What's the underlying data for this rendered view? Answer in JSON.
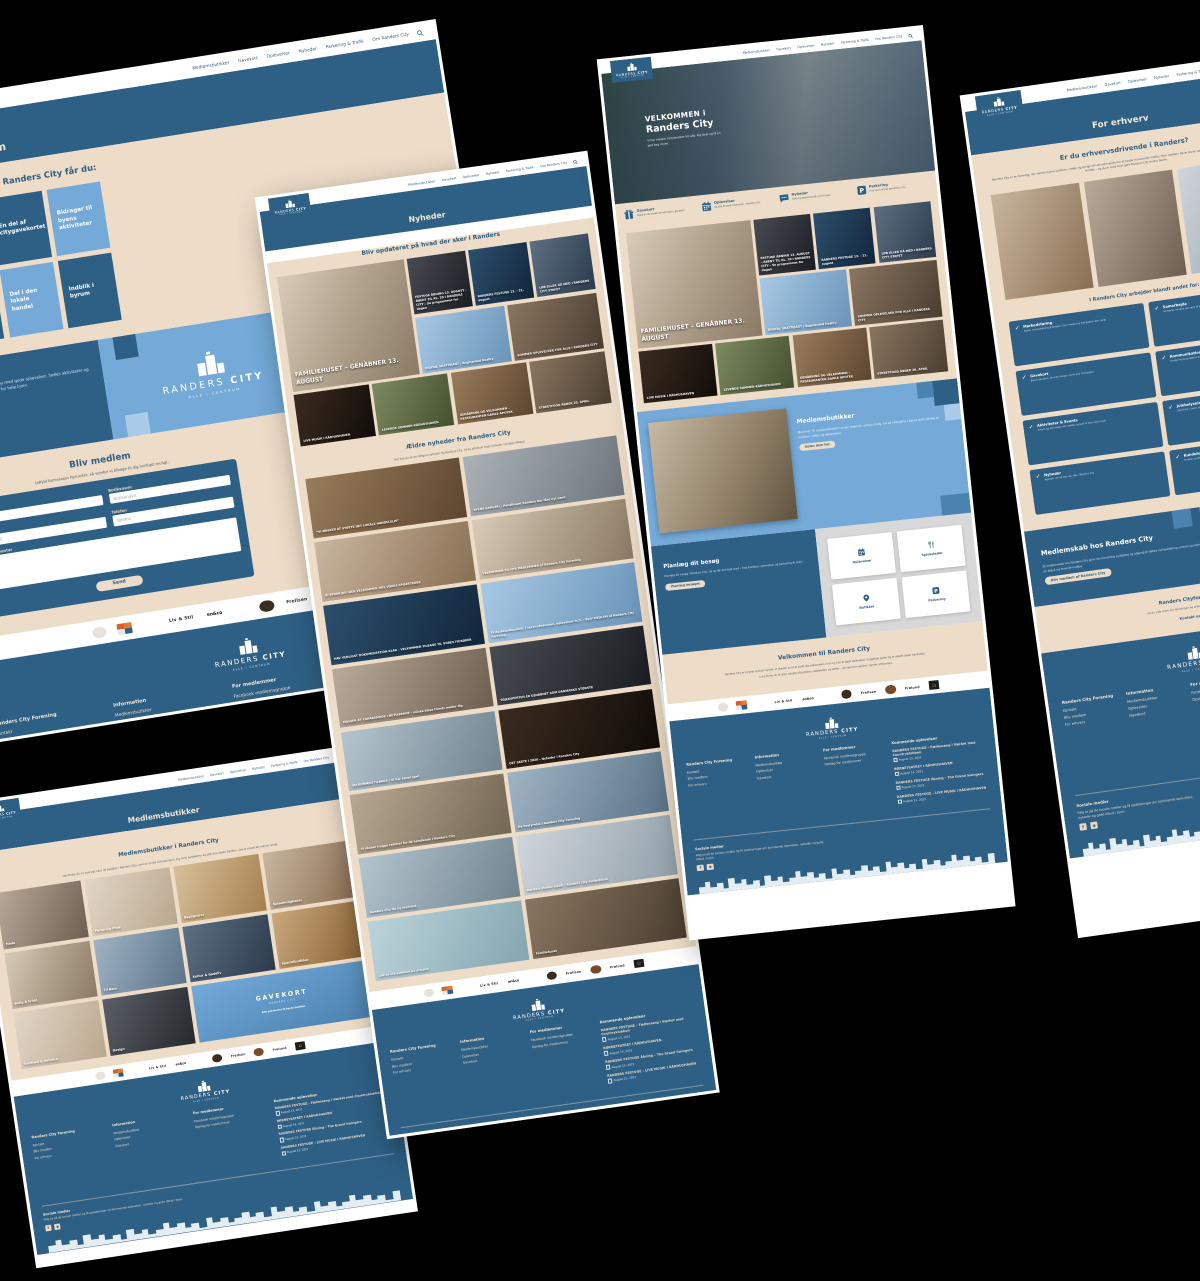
{
  "colors": {
    "navy": "#2e5f84",
    "light_blue": "#74a9d8",
    "pale_blue": "#a9cbe8",
    "beige": "#eddcc7",
    "background": "#000000"
  },
  "brand": {
    "logo_a": "RANDERS",
    "logo_b": "CITY",
    "tagline": "ALLE I CENTRUM"
  },
  "nav": {
    "items": [
      "Medlemsbutikker",
      "Gavekort",
      "Oplevelser",
      "Nyheder",
      "Parkering & Trafik",
      "Om Randers City"
    ],
    "search_icon": "search-icon"
  },
  "partners": [
    {
      "shape": "sh-round",
      "label": ""
    },
    {
      "shape": "sh-pixels",
      "label": ""
    },
    {
      "shape": "sh-text",
      "label": ""
    },
    {
      "shape": "sh-text",
      "label": "Liv & Stil"
    },
    {
      "shape": "sh-stack",
      "label": "en&co"
    },
    {
      "shape": "sh-script",
      "label": ""
    },
    {
      "shape": "sh-round-dark",
      "label": ""
    },
    {
      "shape": "sh-text",
      "label": "Frellsen"
    },
    {
      "shape": "sh-round-brown",
      "label": ""
    },
    {
      "shape": "sh-text",
      "label": "Frølund"
    },
    {
      "shape": "sh-card-dark",
      "label": "12"
    }
  ],
  "news": {
    "featured": {
      "title": "FAMILIEHUSET – GENÅBNER 13. AUGUST",
      "tone": "t-room"
    },
    "row1": [
      {
        "title": "FESTUGE ÅBNING 13. AUGUST – ÅBENT TIL KL. 20 I RANDERS CITY – Se programmet for dagen",
        "tone": "t-dark"
      },
      {
        "title": "RANDERS FESTUGE 13. - 21. august",
        "tone": "t-navy"
      },
      {
        "title": "LØB ELLER GÅ MED I RANDERS CITY STAFET",
        "tone": "t-crowd"
      }
    ],
    "row2": [
      {
        "title": "DIGITAL SKATTEJAGT | Augmented Reality",
        "tone": "t-sky"
      },
      {
        "title": "SOMMER OPLEVELSER FOR ALLE I RANDERS CITY",
        "tone": "t-street"
      }
    ],
    "row3": [
      {
        "title": "LIVE MUSIK I RÅDHUSHAVEN",
        "tone": "t-night"
      },
      {
        "title": "LEVENDE SOMMER-RÅDHUSHAVEN",
        "tone": "t-green"
      },
      {
        "title": "GENÅBNING OG VELKOMMEN – RESTAURANTEN GAMLE APOTEK",
        "tone": "t-warm"
      },
      {
        "title": "STREETFOOD ÅBNER 20. APRIL",
        "tone": "t-street"
      }
    ]
  },
  "footer": {
    "col1": {
      "heading": "Randers City Forening",
      "links": [
        "Kontakt",
        "Bliv medlem",
        "For erhverv"
      ]
    },
    "col2": {
      "heading": "Information",
      "links": [
        "Medlemsbutikker",
        "Oplevelser",
        "Gavekort"
      ]
    },
    "col3": {
      "heading": "For medlemmer",
      "links": [
        "Facebook medlemsgruppe",
        "Opslag for medlemmer"
      ]
    },
    "events_heading": "Kommende oplevelser",
    "events": [
      {
        "title": "RANDERS FESTUGE – Fællessang i Værket med Countryklubben",
        "date": "August 13, 2021"
      },
      {
        "title": "BØRNETEATRET I RÅDHUSHAVEN",
        "date": "August 14, 2021"
      },
      {
        "title": "RANDERS FESTUGE Åbning – The Grand Swingers",
        "date": "August 15, 2021"
      },
      {
        "title": "RANDERS FESTUGE – LIVE MUSIK I RÅDHUSHAVEN",
        "date": "August 21, 2021"
      }
    ],
    "social_heading": "Sociale medier",
    "social_text": "Følg os på de sociale medier og få opdateringer om kommende oplevelser, nyheder og gode tilbud i byen.",
    "social_icons": [
      "facebook-icon",
      "instagram-icon"
    ]
  },
  "bliv_medlem": {
    "title": "Bliv medlem",
    "benefits_heading": "Som medlem af Randers City får du:",
    "benefits": [
      {
        "label": "Årlige netværksaktiviteter",
        "tone": "light"
      },
      {
        "label": "En del af citygavekortet",
        "tone": "dark"
      },
      {
        "label": "Bidrager til byens aktiviteter",
        "tone": "light"
      },
      {
        "label": "Online synlighed",
        "tone": "dark"
      },
      {
        "label": "Del i den lokale handel",
        "tone": "light"
      },
      {
        "label": "Indblik i byrum",
        "tone": "dark"
      }
    ],
    "banner": {
      "heading": "Randers City",
      "text": "Vi arbejder for en levende midtby med gode oplevelser, fælles aktiviteter og en stærk lokal handel – til gavn for hele byen."
    },
    "form": {
      "heading": "Bliv medlem",
      "subheading": "Udfyld formularen herunder, så vender vi tilbage til dig hurtigst muligt.",
      "fields": [
        {
          "label": "Navn",
          "placeholder": "Navn"
        },
        {
          "label": "Butiksnavn",
          "placeholder": "Butiksnavn"
        },
        {
          "label": "E-mail",
          "placeholder": "E-mail"
        },
        {
          "label": "Telefon",
          "placeholder": "Telefon"
        }
      ],
      "textarea_label": "Kommentar",
      "submit_label": "Send"
    }
  },
  "nyheder": {
    "title": "Nyheder",
    "heading": "Bliv opdateret på hvad der sker i Randers",
    "older_heading": "Ældre nyheder fra Randers City",
    "older_sub": "Her kan du se de tidligere nyheder fra Randers City, så du altid kan finde nyheder og kigge tilbage.",
    "articles": [
      {
        "title": "“VI ØNSKER AT STØTTE DET LOKALE HANDELSLIV”",
        "tone": "t-warm"
      },
      {
        "title": "BYENS SAMLERI – Penalhuset Randers har fået nyt navn",
        "tone": "t-grey"
      },
      {
        "title": "VI BYDER JER IGEN VELKOMMEN HOS VORES SPISESTEDER",
        "tone": "t-food"
      },
      {
        "title": "VELKOMMEN TIL NYE MEDLEMMER af Randers City Forening",
        "tone": "t-room"
      },
      {
        "title": "HAV VENLIGST DOKUMENTATION KLAR – VELKOMMEN TILBAGE TIL VORES FRISØRER",
        "tone": "t-navy"
      },
      {
        "title": "Er du detailhandlen, i servicebranchen, oplevelser m.fl. – BLIV MEDLEM af Randers City Forening",
        "tone": "t-sky"
      },
      {
        "title": "MASSER AF FORÅRSMODE I BUTIKKERNE – måske disse trends møder dig",
        "tone": "t-cloth"
      },
      {
        "title": "TØJEKSPERTEN ER GENÅBNET SOM DANMARKS STØRSTE",
        "tone": "t-dark"
      },
      {
        "title": "VELKOMMEN TILBAGE – Vi har åbnet igen",
        "tone": "t-smile"
      },
      {
        "title": "DET SKETE I 2020 – Nyheder i Randers City",
        "tone": "t-night"
      },
      {
        "title": "Vi skaber trygge rammer for de handlende i Randers City",
        "tone": "t-shop"
      },
      {
        "title": "Ny bestyrelse i Randers City Forening",
        "tone": "t-portrait"
      },
      {
        "title": "Randers City får ny identitet",
        "tone": "t-smile"
      },
      {
        "title": "Randers støtter lokalt – Randers City Fordelsklub",
        "tone": "t-poster"
      },
      {
        "title": "Lad os stå sammen på afstand",
        "tone": "t-soap"
      },
      {
        "title": "Familiehuset",
        "tone": "t-street"
      }
    ]
  },
  "forside": {
    "hero": {
      "kicker": "VELKOMMEN i",
      "title": "Randers City",
      "sub": "Vi har masser af oplevelser for alle. Kig forbi og få en god dag i byen."
    },
    "features": [
      {
        "icon": "gift-icon",
        "label": "Gavekort",
        "desc": "Glæd en du holder af med byens gavekort"
      },
      {
        "icon": "calendar-icon",
        "label": "Oplevelser",
        "desc": "Se alle de gode oplevelser i Randers City"
      },
      {
        "icon": "chat-icon",
        "label": "Nyheder",
        "desc": "Hold dig opdateret på nyt fra byen"
      },
      {
        "icon": "parking-icon",
        "label": "Parkering",
        "desc": "Find nemt vej og parkering i city"
      }
    ],
    "butikker": {
      "heading": "Medlemsbutikker",
      "text": "Med over 70 medlemsbutikker er der noget for enhver smag. Gå på opdagelse i byens store udvalg af butikker, caféer og spisesteder.",
      "cta": "Oplev dem her"
    },
    "besoeg": {
      "heading": "Planlæg dit besøg",
      "text": "Planlæg dit besøg i Randers City, så du får det hele med – find butikker, oplevelser og parkering ét sted.",
      "cta": "Planlæg besøget"
    },
    "quick_cards": [
      {
        "icon": "calendar-icon",
        "label": "Oplevelser"
      },
      {
        "icon": "cutlery-icon",
        "label": "Spisesteder"
      },
      {
        "icon": "pin-icon",
        "label": "Butikker"
      },
      {
        "icon": "parking-icon",
        "label": "Parkering"
      }
    ],
    "velkommen": {
      "heading": "Velkommen til Randers City",
      "p1": "Randers City er et godt sted at handle. Vi glæder os til at byde dig velkommen til en by fuld af gode oplevelser, hyggelige gader og et stærkt lokalt handelsliv.",
      "p2": "I city finder du et stort udvalg af butikker, spisesteder og caféer – alt sammen samlet i hjertet af Randers."
    }
  },
  "for_erhverv": {
    "title": "For erhverv",
    "heading": "Er du erhvervsdrivende i Randers?",
    "intro": "Randers City er en forening, der samler byens butikker, caféer og øvrige erhvervsdrivende om at skabe en levende midtby. Som medlem bliver du en del af fællesskabet og får adgang til en række fordele – og du er med til at gøre Randers City endnu bedre.",
    "list_heading": "I Randers City arbejder blandt andet for:",
    "checks": [
      {
        "title": "Markedsføring",
        "desc": "Fælles markedsføring af Randers City i medier og kampagner året rundt"
      },
      {
        "title": "Samarbejde",
        "desc": "Et stærkt netværk på tværs af byens mange erhverv"
      },
      {
        "title": "Gavekort",
        "desc": "Byens gavekort, der kan bruges i mere end 70 butikker"
      },
      {
        "title": "Kommunikation",
        "desc": "Direkte kommunikation til byens kunder og gæster"
      },
      {
        "title": "Aktiviteter & Events",
        "desc": "Events og aktiviteter der trækker kunder til byen året rundt"
      },
      {
        "title": "Julebelysning",
        "desc": "Stemning i byens gader i den mørke tid"
      },
      {
        "title": "Nyheder",
        "desc": "Nyheder om alt det, der sker i Randers City"
      },
      {
        "title": "Kundefordele",
        "desc": "Fordele og tilbud til byens loyale kunder"
      }
    ],
    "medlemskab": {
      "heading": "Medlemskab hos Randers City",
      "text": "Et medlemskab hos Randers City giver din forretning synlighed og adgang til fælles markedsføring, events og netværk i hele byen. Sammen skaber vi en stærk og levende midtby.",
      "cta": "Bliv medlem af Randers City"
    },
    "kontakt": {
      "heading": "Randers Cityforening",
      "text": "Vil du vide mere om foreningen og arbejdet bag Randers City?",
      "cta": "Kontakt os"
    }
  },
  "medlemsbutikker": {
    "title": "Medlemsbutikker",
    "heading": "Medlemsbutikker i Randers City",
    "intro": "Her finder du en oversigt over de butikker i Randers City, som er en del af foreningen. Kig forbi butikkerne og støt den lokale handel – der er noget for enhver smag.",
    "categories": [
      {
        "label": "Mode",
        "tone": "t-cloth"
      },
      {
        "label": "Personlig Pleje",
        "tone": "t-soft"
      },
      {
        "label": "Dagligvarer",
        "tone": "t-citrus"
      },
      {
        "label": "Spisemuligheder",
        "tone": "t-food"
      },
      {
        "label": "Bolig & Fritid",
        "tone": "t-room"
      },
      {
        "label": "Til Børn",
        "tone": "t-portrait"
      },
      {
        "label": "Kultur & Gadeliv",
        "tone": "t-crowd"
      },
      {
        "label": "Specialbutikker",
        "tone": "t-bake"
      },
      {
        "label": "Sundhed & Velvære",
        "tone": "t-soft"
      },
      {
        "label": "Design",
        "tone": "t-dark2"
      },
      {
        "label": "GAVEKORT",
        "sub": "RANDERS CITY",
        "foot": "Køb gavekortet til byens butikker",
        "tone": "t-gave wide gavekort"
      }
    ]
  }
}
